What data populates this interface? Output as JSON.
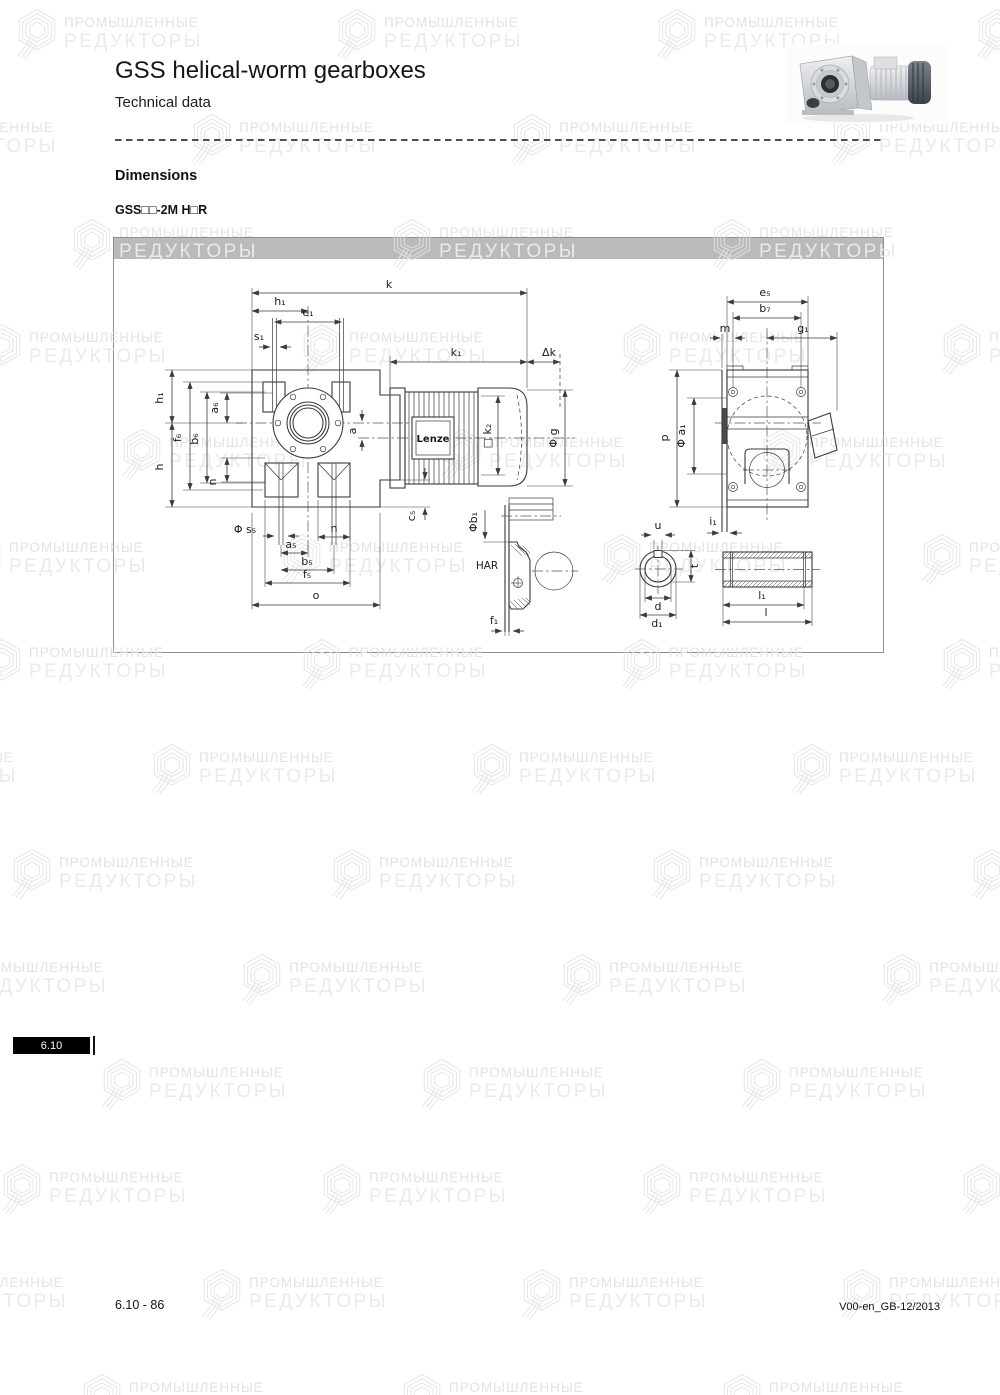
{
  "header": {
    "title": "GSS helical-worm gearboxes",
    "subtitle": "Technical data"
  },
  "section": {
    "heading": "Dimensions",
    "variant": "GSS□□-2M H□R"
  },
  "watermark": {
    "line1": "ПРОМЫШЛЕННЫЕ",
    "line2": "РЕДУКТОРЫ"
  },
  "drawing": {
    "motor_brand": "Lenze",
    "dims": {
      "k": "k",
      "h1": "h₁",
      "e1": "e₁",
      "s1": "s₁",
      "k1": "k₁",
      "dk": "Δk",
      "f6": "f₆",
      "b6": "b₆",
      "a6": "a₆",
      "h": "h",
      "n": "n",
      "a": "a",
      "k2": "□ k₂",
      "g": "Φ g",
      "s5": "Φ s₅",
      "a5": "a₅",
      "b5": "b₅",
      "f5": "f₅",
      "o": "o",
      "c5": "c₅",
      "b1": "Φb₁",
      "har": "HAR",
      "f1": "f₁",
      "e5": "e₅",
      "b7": "b₇",
      "m": "m",
      "g1": "g₁",
      "p": "p",
      "a1": "Φ a₁",
      "i1": "i₁",
      "u": "u",
      "t": "t",
      "d": "d",
      "d1": "d₁",
      "l1": "l₁",
      "l": "l"
    }
  },
  "footer": {
    "tab": "6.10",
    "page_number": "6.10 - 86",
    "doc_code": "V00-en_GB-12/2013"
  }
}
